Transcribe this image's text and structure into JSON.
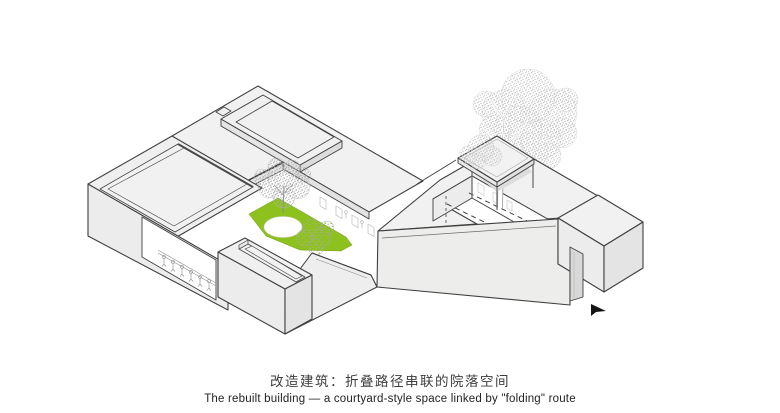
{
  "caption": {
    "zh": "改造建筑：折叠路径串联的院落空间",
    "en": "The rebuilt building — a courtyard-style space linked by \"folding\" route"
  },
  "drawing": {
    "type": "axonometric architectural diagram of rebuilt courtyard building",
    "elements": [
      "main-roof-block-with-skylight-ring",
      "west-block-with-roof-rim",
      "front-block-with-linear-skylight",
      "central-courtyard-lawn-with-tree-and-circular-paving",
      "shrub",
      "veranda-with-long-table-and-people",
      "folding-ramp-route",
      "right-wing-with-sunken-courtyard-lawn",
      "dashed-hidden-route-lines",
      "end-block-with-door-recess",
      "pavilion-slab-on-columns",
      "large-stippled-tree",
      "cursor-arrow-marker"
    ],
    "colors": {
      "background": "#ffffff",
      "line": "#404040",
      "roof": "#f1f1f1",
      "wall_light": "#ececec",
      "wall_shade": "#e4e4e4",
      "wall_dark": "#d8d8d8",
      "lawn_green": "#8dc21e",
      "foliage_stipple": "#b9b9b9",
      "sketch_gray": "#b0b0b0",
      "cursor": "#151515"
    }
  }
}
